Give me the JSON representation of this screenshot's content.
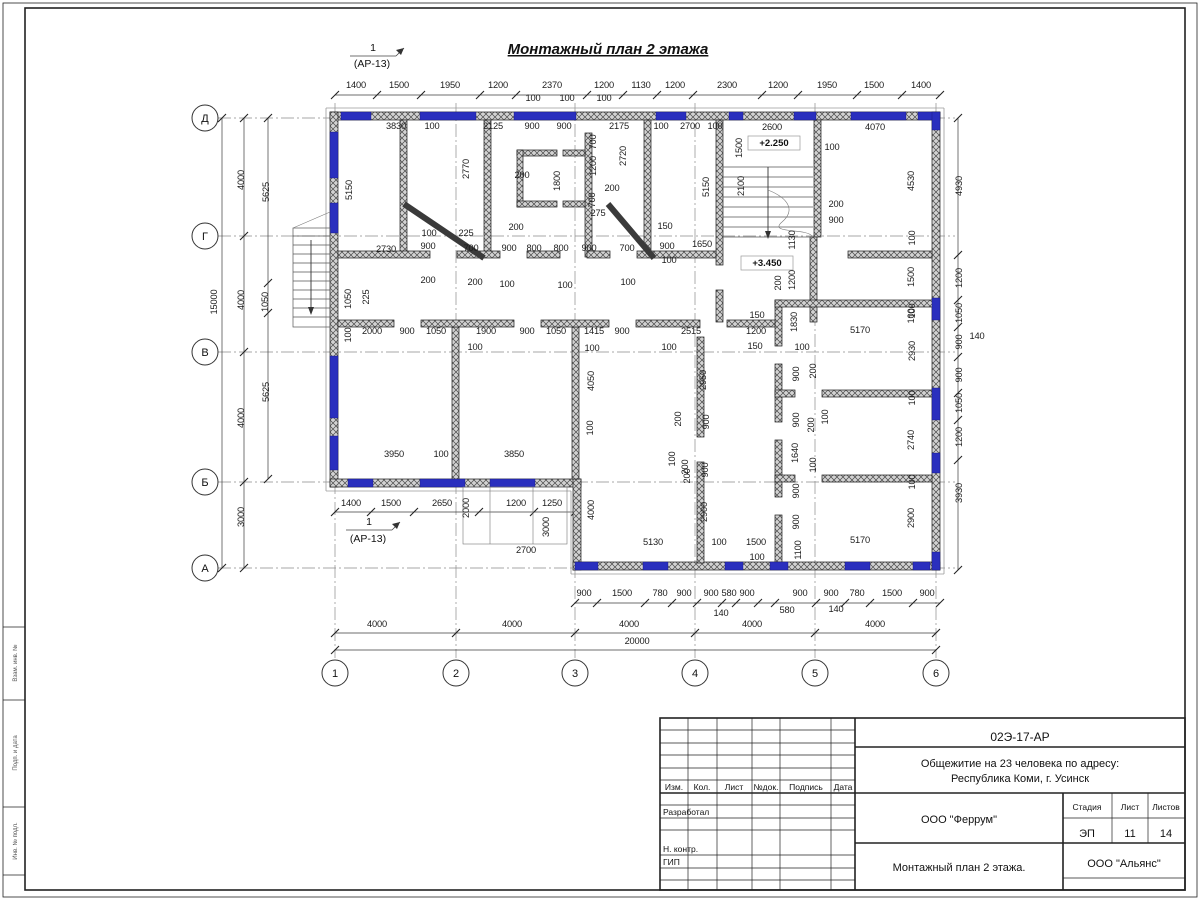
{
  "sheet": {
    "title": "Монтажный план 2 этажа"
  },
  "markers": {
    "number": "1",
    "sheet_ref": "(АР-13)"
  },
  "levels": {
    "upper": "+2.250",
    "lower": "+3.450"
  },
  "frame_labels": [
    "Взам. инв. №",
    "Подп. и дата",
    "Инв. № подл."
  ],
  "axes": {
    "rows": [
      {
        "label": "Д",
        "y": 118
      },
      {
        "label": "Г",
        "y": 236
      },
      {
        "label": "В",
        "y": 352
      },
      {
        "label": "Б",
        "y": 482
      },
      {
        "label": "А",
        "y": 568
      }
    ],
    "cols": [
      {
        "label": "1",
        "x": 335
      },
      {
        "label": "2",
        "x": 456
      },
      {
        "label": "3",
        "x": 575
      },
      {
        "label": "4",
        "x": 695
      },
      {
        "label": "5",
        "x": 815
      },
      {
        "label": "6",
        "x": 936
      }
    ]
  },
  "dims": [
    [
      "1400",
      356,
      88,
      0
    ],
    [
      "1500",
      399,
      88,
      0
    ],
    [
      "1950",
      450,
      88,
      0
    ],
    [
      "1200",
      498,
      88,
      0
    ],
    [
      "2370",
      552,
      88,
      0
    ],
    [
      "1200",
      604,
      88,
      0
    ],
    [
      "1130",
      641,
      88,
      0
    ],
    [
      "1200",
      675,
      88,
      0
    ],
    [
      "2300",
      727,
      88,
      0
    ],
    [
      "1200",
      778,
      88,
      0
    ],
    [
      "1950",
      827,
      88,
      0
    ],
    [
      "1500",
      874,
      88,
      0
    ],
    [
      "1400",
      921,
      88,
      0
    ],
    [
      "100",
      533,
      101,
      0
    ],
    [
      "100",
      567,
      101,
      0
    ],
    [
      "100",
      604,
      101,
      0
    ],
    [
      "3830",
      396,
      129,
      0
    ],
    [
      "100",
      432,
      129,
      0
    ],
    [
      "2125",
      493,
      129,
      0
    ],
    [
      "900",
      532,
      129,
      0
    ],
    [
      "900",
      564,
      129,
      0
    ],
    [
      "2175",
      619,
      129,
      0
    ],
    [
      "100",
      661,
      129,
      0
    ],
    [
      "2700",
      690,
      129,
      0
    ],
    [
      "100",
      715,
      129,
      0
    ],
    [
      "2600",
      772,
      130,
      0
    ],
    [
      "4070",
      875,
      130,
      0
    ],
    [
      "1500",
      742,
      148,
      1
    ],
    [
      "2100",
      744,
      186,
      1
    ],
    [
      "100",
      832,
      150,
      0
    ],
    [
      "200",
      836,
      207,
      0
    ],
    [
      "900",
      836,
      223,
      0
    ],
    [
      "4530",
      914,
      181,
      1
    ],
    [
      "100",
      915,
      238,
      1
    ],
    [
      "5150",
      352,
      190,
      1
    ],
    [
      "2770",
      469,
      169,
      1
    ],
    [
      "1800",
      560,
      181,
      1
    ],
    [
      "700",
      596,
      142,
      1
    ],
    [
      "1200",
      596,
      166,
      1
    ],
    [
      "700",
      595,
      200,
      1
    ],
    [
      "2720",
      626,
      156,
      1
    ],
    [
      "275",
      598,
      216,
      0
    ],
    [
      "200",
      612,
      191,
      0
    ],
    [
      "200",
      522,
      178,
      0
    ],
    [
      "200",
      516,
      230,
      0
    ],
    [
      "5150",
      709,
      187,
      1
    ],
    [
      "2730",
      386,
      252,
      0
    ],
    [
      "900",
      428,
      249,
      0
    ],
    [
      "100",
      429,
      236,
      0
    ],
    [
      "225",
      466,
      236,
      0
    ],
    [
      "700",
      471,
      251,
      0
    ],
    [
      "900",
      509,
      251,
      0
    ],
    [
      "800",
      534,
      251,
      0
    ],
    [
      "800",
      561,
      251,
      0
    ],
    [
      "900",
      589,
      251,
      0
    ],
    [
      "700",
      627,
      251,
      0
    ],
    [
      "150",
      665,
      229,
      0
    ],
    [
      "900",
      667,
      249,
      0
    ],
    [
      "100",
      669,
      263,
      0
    ],
    [
      "1650",
      702,
      247,
      0
    ],
    [
      "200",
      428,
      283,
      0
    ],
    [
      "200",
      475,
      285,
      0
    ],
    [
      "100",
      507,
      287,
      0
    ],
    [
      "100",
      565,
      288,
      0
    ],
    [
      "100",
      628,
      285,
      0
    ],
    [
      "4000",
      244,
      180,
      1
    ],
    [
      "5625",
      269,
      192,
      1
    ],
    [
      "15000",
      217,
      302,
      1
    ],
    [
      "4000",
      244,
      300,
      1
    ],
    [
      "1050",
      268,
      302,
      1
    ],
    [
      "4000",
      244,
      418,
      1
    ],
    [
      "5625",
      269,
      392,
      1
    ],
    [
      "3000",
      244,
      517,
      1
    ],
    [
      "1050",
      351,
      299,
      1
    ],
    [
      "225",
      369,
      297,
      1
    ],
    [
      "100",
      351,
      335,
      1
    ],
    [
      "2000",
      372,
      334,
      0
    ],
    [
      "900",
      407,
      334,
      0
    ],
    [
      "1050",
      436,
      334,
      0
    ],
    [
      "1900",
      486,
      334,
      0
    ],
    [
      "900",
      527,
      334,
      0
    ],
    [
      "1050",
      556,
      334,
      0
    ],
    [
      "1415",
      594,
      334,
      0
    ],
    [
      "900",
      622,
      334,
      0
    ],
    [
      "2515",
      691,
      334,
      0
    ],
    [
      "150",
      757,
      318,
      0
    ],
    [
      "1200",
      756,
      334,
      0
    ],
    [
      "150",
      755,
      349,
      0
    ],
    [
      "1830",
      797,
      322,
      1
    ],
    [
      "5170",
      860,
      333,
      0
    ],
    [
      "100",
      914,
      316,
      1
    ],
    [
      "2930",
      915,
      351,
      1
    ],
    [
      "100",
      475,
      350,
      0
    ],
    [
      "100",
      592,
      351,
      0
    ],
    [
      "100",
      669,
      350,
      0
    ],
    [
      "100",
      802,
      350,
      0
    ],
    [
      "1130",
      795,
      240,
      1
    ],
    [
      "1200",
      795,
      280,
      1
    ],
    [
      "200",
      781,
      283,
      1
    ],
    [
      "4050",
      594,
      381,
      1
    ],
    [
      "100",
      593,
      428,
      1
    ],
    [
      "2950",
      706,
      380,
      1
    ],
    [
      "200",
      681,
      419,
      1
    ],
    [
      "900",
      709,
      422,
      1
    ],
    [
      "100",
      675,
      459,
      1
    ],
    [
      "200",
      688,
      467,
      1
    ],
    [
      "900",
      708,
      470,
      1
    ],
    [
      "900",
      799,
      374,
      1
    ],
    [
      "200",
      816,
      371,
      1
    ],
    [
      "900",
      799,
      420,
      1
    ],
    [
      "200",
      814,
      425,
      1
    ],
    [
      "100",
      828,
      417,
      1
    ],
    [
      "1640",
      798,
      453,
      1
    ],
    [
      "100",
      816,
      465,
      1
    ],
    [
      "1500",
      914,
      277,
      1
    ],
    [
      "100",
      915,
      311,
      1
    ],
    [
      "2740",
      914,
      440,
      1
    ],
    [
      "100",
      915,
      398,
      1
    ],
    [
      "100",
      915,
      482,
      1
    ],
    [
      "2900",
      914,
      518,
      1
    ],
    [
      "3950",
      394,
      457,
      0
    ],
    [
      "100",
      441,
      457,
      0
    ],
    [
      "3850",
      514,
      457,
      0
    ],
    [
      "1400",
      351,
      506,
      0
    ],
    [
      "1500",
      391,
      506,
      0
    ],
    [
      "2650",
      442,
      506,
      0
    ],
    [
      "1200",
      516,
      506,
      0
    ],
    [
      "1250",
      552,
      506,
      0
    ],
    [
      "2000",
      469,
      508,
      1
    ],
    [
      "3000",
      549,
      527,
      1
    ],
    [
      "2700",
      526,
      553,
      0
    ],
    [
      "4000",
      594,
      510,
      1
    ],
    [
      "2900",
      707,
      512,
      1
    ],
    [
      "200",
      690,
      476,
      1
    ],
    [
      "5130",
      653,
      545,
      0
    ],
    [
      "100",
      719,
      545,
      0
    ],
    [
      "1500",
      756,
      545,
      0
    ],
    [
      "100",
      757,
      560,
      0
    ],
    [
      "1100",
      801,
      550,
      1
    ],
    [
      "900",
      799,
      522,
      1
    ],
    [
      "900",
      799,
      491,
      1
    ],
    [
      "5170",
      860,
      543,
      0
    ],
    [
      "900",
      584,
      596,
      0
    ],
    [
      "1500",
      622,
      596,
      0
    ],
    [
      "780",
      660,
      596,
      0
    ],
    [
      "900",
      684,
      596,
      0
    ],
    [
      "900",
      711,
      596,
      0
    ],
    [
      "580",
      729,
      596,
      0
    ],
    [
      "900",
      747,
      596,
      0
    ],
    [
      "900",
      800,
      596,
      0
    ],
    [
      "900",
      831,
      596,
      0
    ],
    [
      "780",
      857,
      596,
      0
    ],
    [
      "1500",
      892,
      596,
      0
    ],
    [
      "900",
      927,
      596,
      0
    ],
    [
      "140",
      721,
      616,
      0
    ],
    [
      "580",
      787,
      613,
      0
    ],
    [
      "140",
      836,
      612,
      0
    ],
    [
      "4000",
      377,
      627,
      0
    ],
    [
      "4000",
      512,
      627,
      0
    ],
    [
      "4000",
      629,
      627,
      0
    ],
    [
      "4000",
      752,
      627,
      0
    ],
    [
      "4000",
      875,
      627,
      0
    ],
    [
      "20000",
      637,
      644,
      0
    ],
    [
      "4930",
      962,
      186,
      1
    ],
    [
      "1200",
      962,
      278,
      1
    ],
    [
      "1050",
      962,
      313,
      1
    ],
    [
      "900",
      962,
      342,
      1
    ],
    [
      "900",
      962,
      375,
      1
    ],
    [
      "1050",
      962,
      403,
      1
    ],
    [
      "1200",
      962,
      437,
      1
    ],
    [
      "3930",
      962,
      493,
      1
    ],
    [
      "140",
      977,
      339,
      0
    ]
  ],
  "title_block": {
    "code": "02Э-17-АР",
    "project_line1": "Общежитие на 23 человека по адресу:",
    "project_line2": "Республика Коми, г. Усинск",
    "designer_org": "ООО \"Феррум\"",
    "sheet_title": "Монтажный план 2 этажа.",
    "client_org": "ООО \"Альянс\"",
    "stage_label": "Стадия",
    "sheet_label": "Лист",
    "sheets_label": "Листов",
    "stage": "ЭП",
    "sheet_no": "11",
    "sheets_total": "14",
    "cols": [
      "Изм.",
      "Кол.",
      "Лист",
      "№док.",
      "Подпись",
      "Дата"
    ],
    "rows": [
      "Разработал",
      "Н. контр.",
      "ГИП"
    ]
  }
}
